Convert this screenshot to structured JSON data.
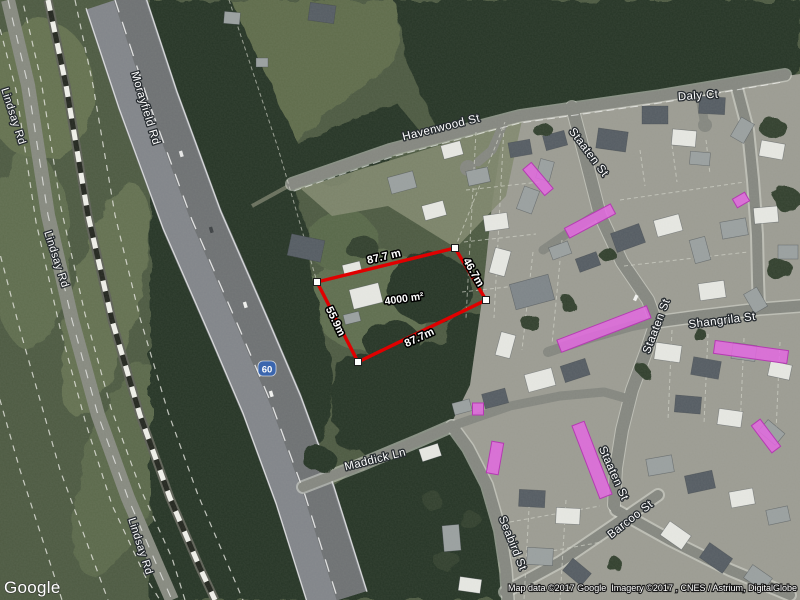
{
  "labels": {
    "morayfield_rd": "Morayfield Rd",
    "lindsay_rd": "Lindsay Rd",
    "havenwood_st": "Havenwood St",
    "daly_ct": "Daly Ct",
    "staaten_st": "Staaten St",
    "shangrila_st": "Shangrila St",
    "maddick_ln": "Maddick Ln",
    "seabird_st": "Seabird St",
    "barcoo_st": "Barcoo St",
    "route_number": "60"
  },
  "parcel": {
    "area_label": "4000 m²",
    "side_top": "87.7 m",
    "side_right": "46.7m",
    "side_left": "55.9m",
    "side_bottom": "87.7m",
    "outline_color": "#e00000"
  },
  "highlight_color": "#e36ae0",
  "route_shield_color": "#3b66ae",
  "branding": {
    "logo": "Google",
    "map_data": "Map data ©2017 Google",
    "imagery": "Imagery ©2017 , CNES / Astrium, DigitalGlobe"
  }
}
